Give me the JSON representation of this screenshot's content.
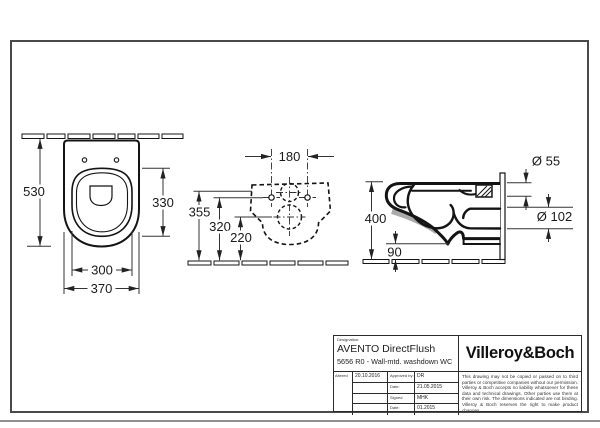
{
  "sheet": {
    "dims": {
      "plan": {
        "depth": "530",
        "bowl_length": "330",
        "inner_width": "300",
        "outer_width": "370"
      },
      "rear": {
        "hole_spacing": "180",
        "rim_height": "355",
        "hole_height": "320",
        "outlet_height": "220"
      },
      "side": {
        "total_height": "400",
        "bottom_height": "90",
        "inlet_diameter": "Ø 55",
        "outlet_diameter": "Ø 102"
      }
    },
    "title_block": {
      "designation_label": "Designation:",
      "product_name": "AVENTO DirectFlush",
      "product_code": "5656 R0 - Wall-mtd. washdown WC",
      "brand": "Villeroy&Boch",
      "altered_label": "Altered",
      "altered_value": "20.10.2016",
      "approvals": [
        {
          "label": "Approved by:",
          "value": "DR"
        },
        {
          "label": "Date:",
          "value": "21.05.2015"
        },
        {
          "label": "Signed",
          "value": "MHK"
        },
        {
          "label": "Date:",
          "value": "01.2015"
        }
      ],
      "disclaimer": "This drawing may not be copied or passed on to third parties or competitive companies without our permission. Villeroy & Boch accepts no liability whatsoever for these data and technical drawings. Other parties use them at their own risk. The dimensions indicated are not binding. Villeroy & Boch reserves the right to make product changes."
    },
    "colors": {
      "line": "#141414",
      "dim_line": "#333333",
      "frame": "#4a4a4a",
      "shade": "#ababab",
      "page_edge": "#909090"
    }
  }
}
